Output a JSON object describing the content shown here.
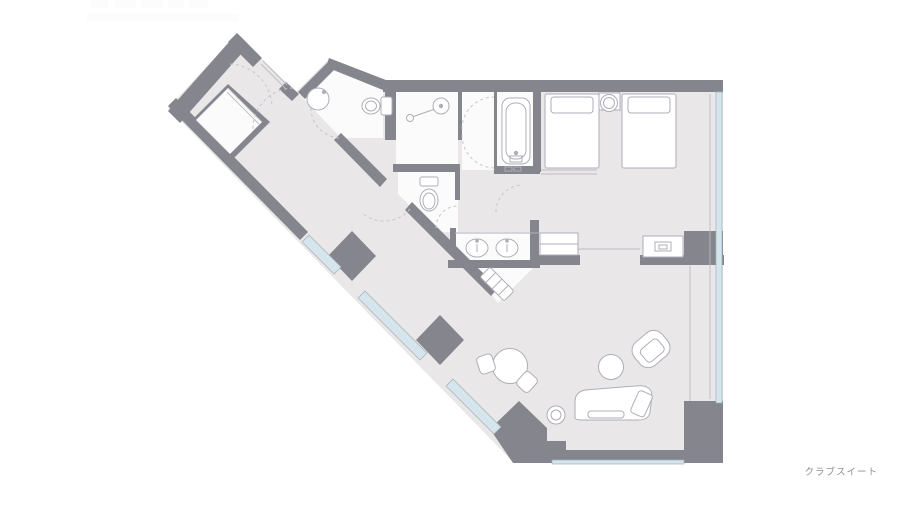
{
  "suite": {
    "label": "クラブスイート",
    "colors": {
      "wall": "#85858e",
      "floor": "#eae7e8",
      "room": "#fbfbfb",
      "window": "#d6e4eb",
      "line": "#aeaeb8",
      "arc": "#c6c6ce",
      "label_text": "#8f8f96"
    },
    "rooms": [
      "entry-hall",
      "closet",
      "powder-room",
      "shower-room",
      "bath-lobby",
      "bathtub-room",
      "wc",
      "vanity",
      "dressing-area",
      "bedroom",
      "living-room",
      "corridor"
    ],
    "fixtures": [
      "round-sink",
      "toilet",
      "shower-head",
      "bathtub",
      "toilet",
      "double-vanity-sinks",
      "luggage-bench"
    ],
    "furniture": [
      "bed",
      "bed",
      "nightstand",
      "cabinet",
      "tv-cabinet",
      "dining-table",
      "dining-chair",
      "dining-chair",
      "coffee-table",
      "armchair",
      "chaise-sofa",
      "side-table"
    ],
    "watermark_present": true
  }
}
